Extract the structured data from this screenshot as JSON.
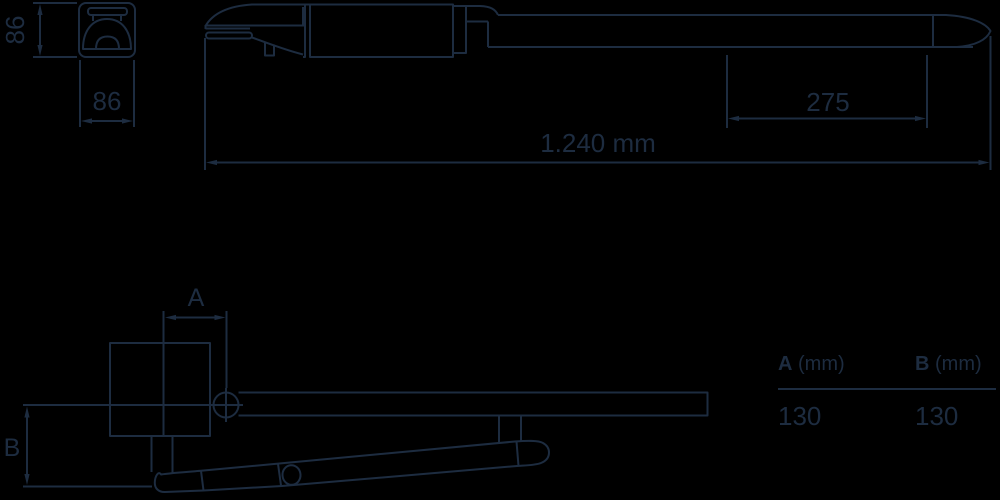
{
  "colors": {
    "line": "#1d2c40",
    "background": "#000000"
  },
  "section_view": {
    "dim_height": "86",
    "dim_width": "86"
  },
  "side_view": {
    "dim_segment": "275",
    "dim_total": "1.240 mm"
  },
  "plan_view": {
    "dim_a_label": "A",
    "dim_b_label": "B"
  },
  "table": {
    "columns": [
      {
        "key": "A",
        "unit": " (mm)",
        "value": "130"
      },
      {
        "key": "B",
        "unit": " (mm)",
        "value": "130"
      }
    ]
  }
}
